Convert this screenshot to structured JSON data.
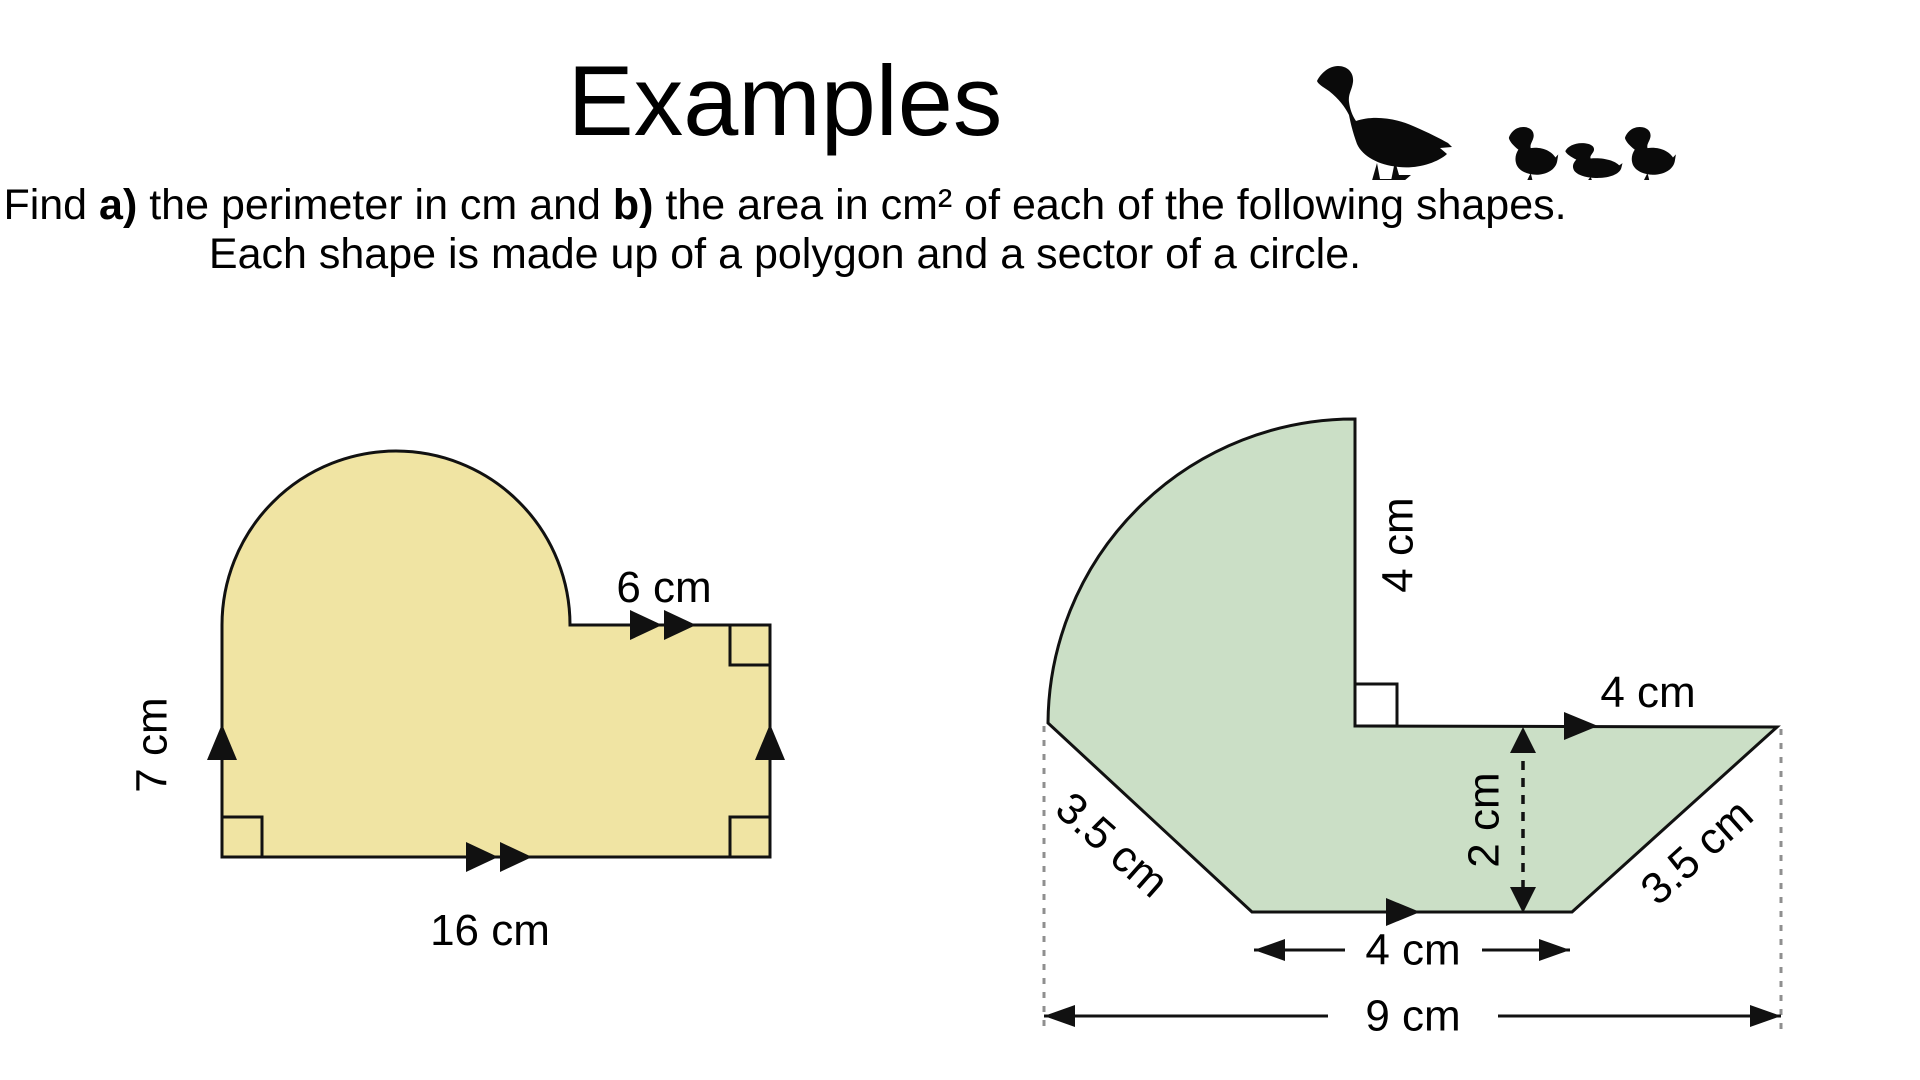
{
  "slide": {
    "title": "Examples",
    "instructions": {
      "line1": [
        {
          "text": "Find "
        },
        {
          "text": "a)",
          "bold": true
        },
        {
          "text": " the perimeter in cm and "
        },
        {
          "text": "b)",
          "bold": true
        },
        {
          "text": " the area in cm² of each of the following shapes."
        }
      ],
      "line2": "Each shape is made up of a polygon and a sector of a circle."
    }
  },
  "decor": {
    "duck_family_icon": "black silhouette of a mother duck followed by three ducklings walking left"
  },
  "diagram": {
    "stroke_color": "#111111",
    "guide_color": "#8f8f8f",
    "left_shape": {
      "description": "rectangle topped by a semicircle (polygon + sector)",
      "fill": "#F0E4A3",
      "labels": {
        "top_segment": "6 cm",
        "left_side": "7 cm",
        "bottom_side": "16 cm"
      }
    },
    "right_shape": {
      "description": "trapezium with a quarter-circle sector on top (polygon + sector)",
      "fill": "#CBDFC6",
      "labels": {
        "radius": "4 cm",
        "top_right_segment": "4 cm",
        "left_slant": "3.5 cm",
        "right_slant": "3.5 cm",
        "height": "2 cm",
        "bottom_segment": "4 cm",
        "total_width": "9 cm"
      }
    }
  }
}
